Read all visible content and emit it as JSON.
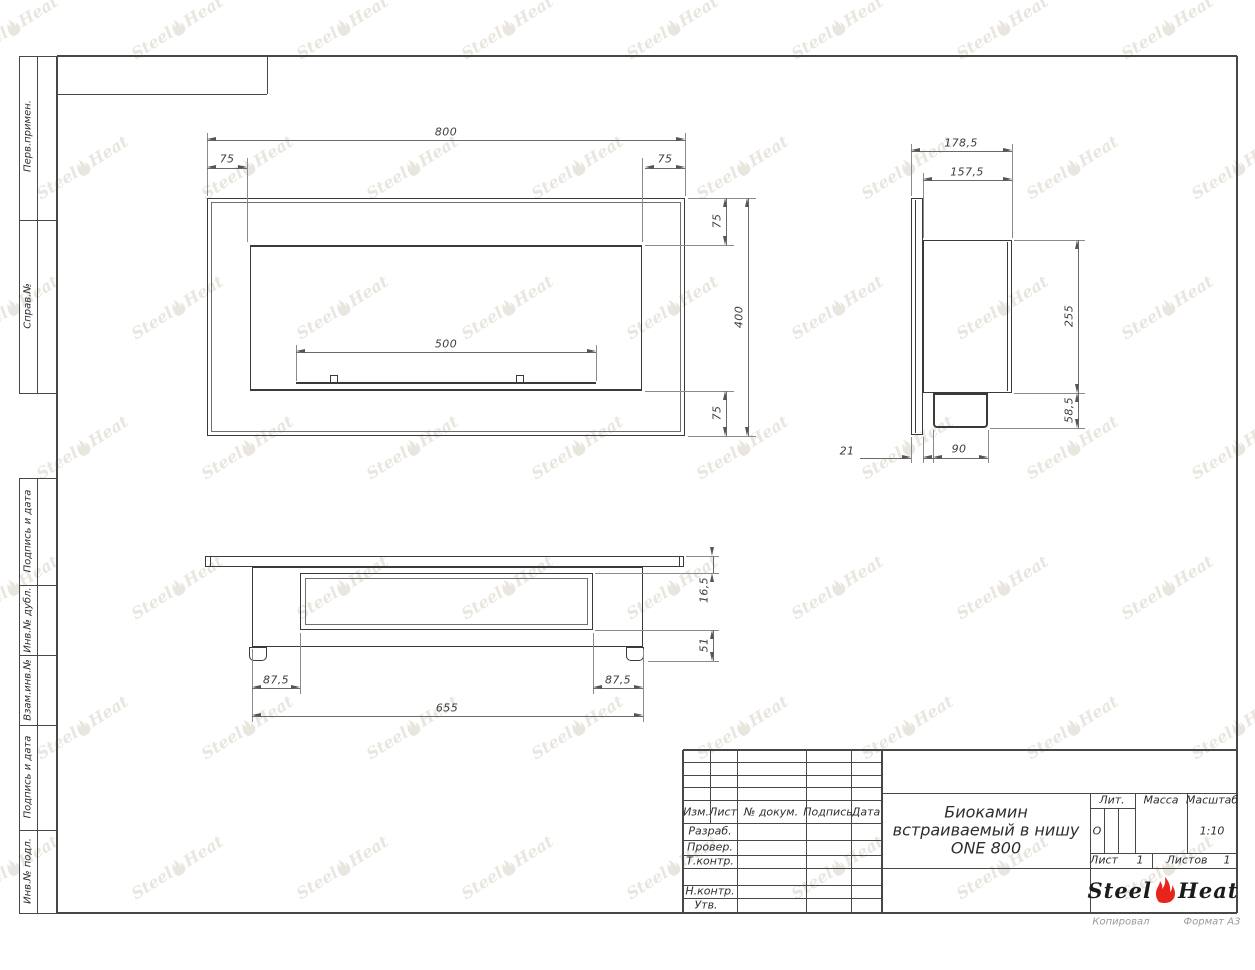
{
  "stamp": {
    "left_labels": [
      "Перв.примен.",
      "Справ.№",
      "Подпись и дата",
      "Инв.№ дубл.",
      "Взам.инв.№",
      "Подпись и дата",
      "Инв.№ подл."
    ]
  },
  "title_block": {
    "header_cols": [
      "Изм.",
      "Лист",
      "№ докум.",
      "Подпись",
      "Дата"
    ],
    "row_labels": [
      "Разраб.",
      "Провер.",
      "Т.контр.",
      "Н.контр.",
      "Утв."
    ],
    "lit_label": "Лит.",
    "lit_value": "О",
    "mass_label": "Масса",
    "scale_label": "Масштаб",
    "scale_value": "1:10",
    "sheet_label": "Лист",
    "sheet_value": "1",
    "sheets_label": "Листов",
    "sheets_value": "1",
    "title_line1": "Биокамин",
    "title_line2": "встраиваемый в нишу",
    "title_line3": "ONE 800",
    "logo_left": "Steel",
    "logo_right": "Heat",
    "copied_label": "Копировал",
    "format_label": "Формат А3"
  },
  "dims": {
    "front": {
      "width": "800",
      "margin_left": "75",
      "margin_right": "75",
      "margin_top": "75",
      "height": "400",
      "margin_bottom": "75",
      "opening_width": "500"
    },
    "side": {
      "depth_total": "178,5",
      "depth_body": "157,5",
      "body_height": "255",
      "tray_height": "58,5",
      "wall_thickness": "21",
      "tray_depth": "90"
    },
    "bottom": {
      "flange_depth": "16,5",
      "inner_depth": "51",
      "offset_left": "87,5",
      "offset_right": "87,5",
      "body_width": "655"
    }
  },
  "watermark": {
    "text_left": "Steel",
    "text_right": "Heat"
  },
  "colors": {
    "line": "#3a3a3a",
    "flame_red": "#e8251d",
    "watermark": "#d8d1c6"
  }
}
